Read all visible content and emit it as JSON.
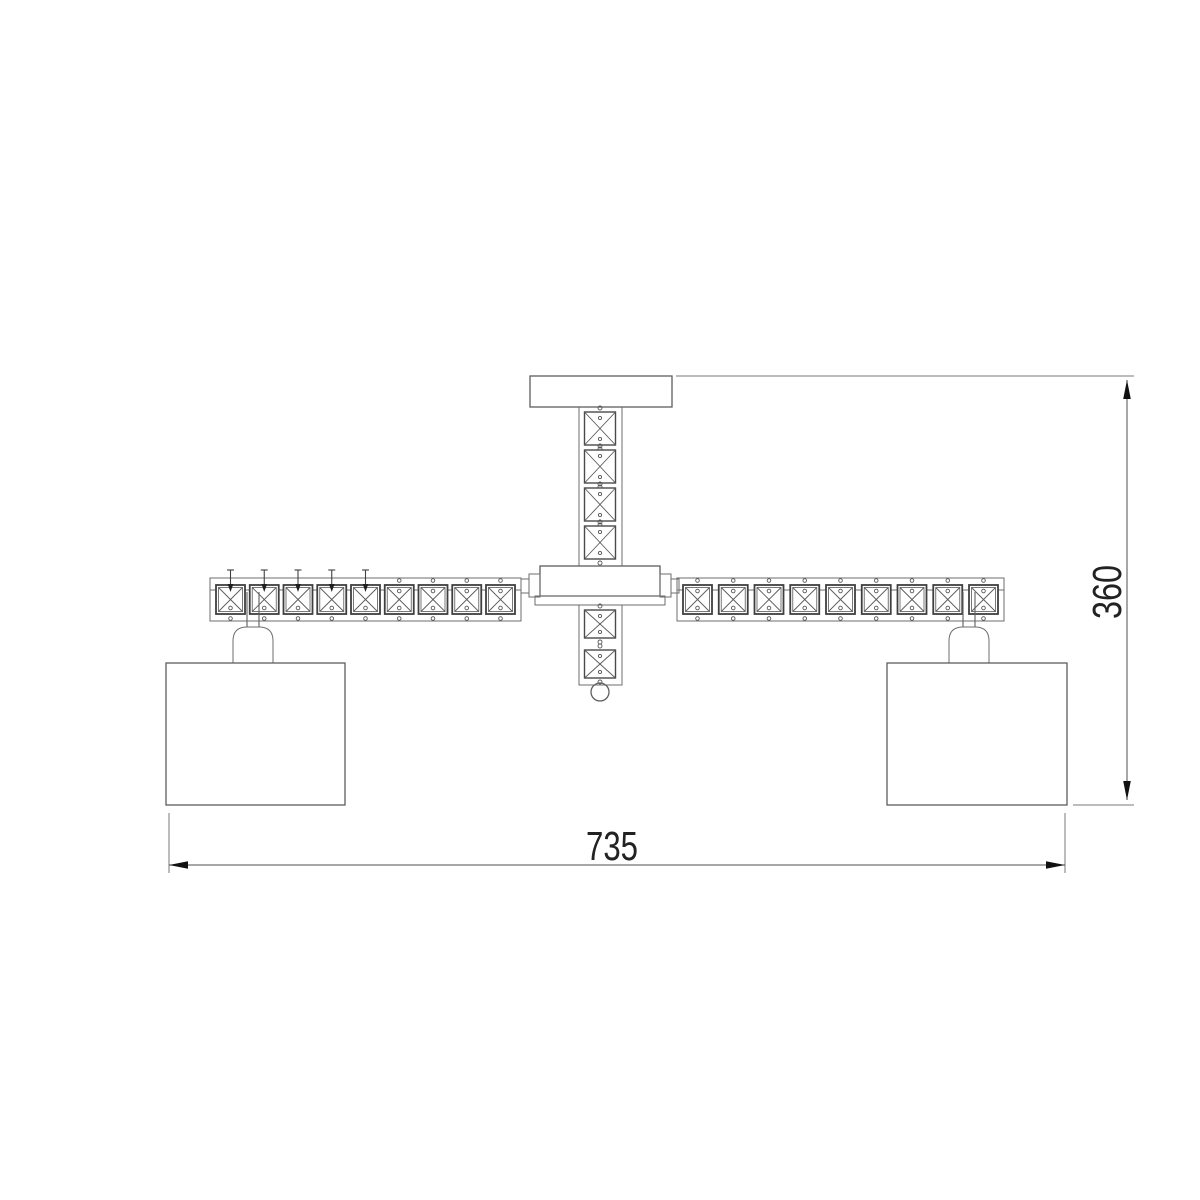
{
  "drawing": {
    "type": "technical-line-drawing",
    "subject": "two-arm crystal ceiling chandelier, front elevation with overall dimensions",
    "dimensions": {
      "width_label": "735",
      "height_label": "360"
    },
    "structure": {
      "arm_crystals_per_side": 9,
      "left_arm_pinned_crystals": 5,
      "stem_crystals_above_hub": 4,
      "stem_crystals_below_hub": 2,
      "shade_count": 2,
      "finial": "ball"
    },
    "colors": {
      "background": "#ffffff",
      "outline": "#5e5e5e",
      "crystal_outline": "#3f3f3f",
      "dimension_text": "#222222",
      "arrowhead": "#111111"
    }
  }
}
